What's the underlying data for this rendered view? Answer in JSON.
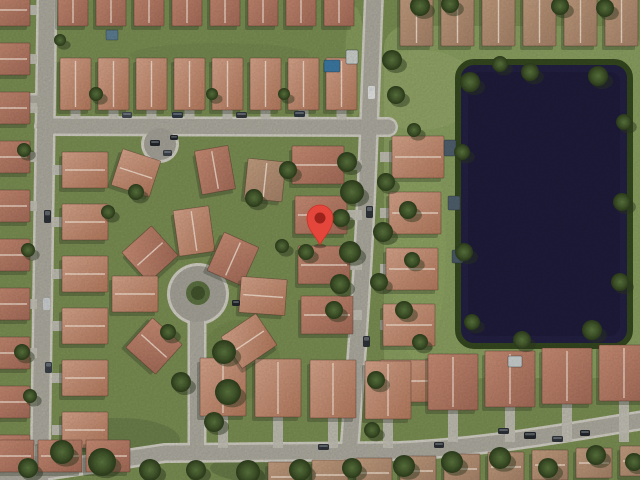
{
  "app": {
    "name": "satellite-map-view",
    "view_mode": "satellite"
  },
  "map": {
    "width": 640,
    "height": 480,
    "marker": {
      "tip_x": 320,
      "tip_y": 245,
      "head_dy": -27,
      "head_r": 13,
      "inner_r": 5.5,
      "color": "#e5463b",
      "edge_color": "#c63327",
      "inner_color": "#9c231b"
    },
    "palette": {
      "grass": "#7d9154",
      "lake_zone_grass": "#8ca262",
      "road": "#b0ada2",
      "road_edge": "#d6d3c8",
      "court_pavement": "#a8a59b",
      "island": "#5d7342",
      "island_tree": "#43552e",
      "driveway": "#c6c3b8",
      "lake": "#232043",
      "lake_edge": "#35491f",
      "house_shadow": "#2b3424",
      "roof_edge": "rgba(80,50,40,0.5)",
      "ridge": "rgba(255,238,222,0.8)",
      "tree_shadow": "#2c3a1e",
      "roof_gradients": [
        [
          "#cd9077",
          "#a86e5a"
        ],
        [
          "#dca88e",
          "#b77c5f"
        ],
        [
          "#c7a283",
          "#a9846a"
        ]
      ],
      "tree_gradient": [
        "#5d7840",
        "#44592c",
        "#2e3f1d"
      ]
    },
    "lake": {
      "x": 458,
      "y": 62,
      "w": 172,
      "h": 284,
      "rx": 16
    },
    "lake_zone": {
      "x": 384,
      "y": 26,
      "w": 256,
      "h": 352,
      "rx": 22
    },
    "roads": [
      {
        "d": "M 47,-5 L 40,485",
        "w": 16
      },
      {
        "d": "M -4,101 L 44,101",
        "w": 11
      },
      {
        "d": "M 44,126 L 388,127",
        "w": 15
      },
      {
        "d": "M 374,-6 L 369,127 C 366,210 362,292 349,454",
        "w": 15
      },
      {
        "d": "M -8,479 L 165,453 L 400,451 C 490,447 568,432 644,420",
        "w": 15
      },
      {
        "d": "M 197,452 L 197,312",
        "w": 14
      },
      {
        "d": "M 160,148 L 160,124",
        "w": 10
      }
    ],
    "circles": [
      {
        "cx": 198,
        "cy": 294,
        "r": 28,
        "kind": "cul-de-sac"
      },
      {
        "cx": 160,
        "cy": 144,
        "r": 16,
        "kind": "parking-court"
      }
    ],
    "island": {
      "cx": 198,
      "cy": 293,
      "r": 12,
      "tree_r": 7
    },
    "house_rows": [
      {
        "x": 58,
        "y": -20,
        "n": 8,
        "dx": 38,
        "dy": 0,
        "w": 30,
        "h": 46,
        "v": 0
      },
      {
        "x": 60,
        "y": 58,
        "n": 8,
        "dx": 38,
        "dy": 0,
        "w": 31,
        "h": 52,
        "v": 1,
        "drive": "S",
        "road": 119
      },
      {
        "x": 400,
        "y": -12,
        "n": 6,
        "dx": 41,
        "dy": 0,
        "w": 33,
        "h": 58,
        "v": 2
      },
      {
        "x": -16,
        "y": -6,
        "n": 10,
        "dx": 0,
        "dy": 49,
        "w": 46,
        "h": 32,
        "v": 0,
        "drive": "E",
        "road": 37
      },
      {
        "x": 62,
        "y": 152,
        "n": 6,
        "dx": 0,
        "dy": 52,
        "w": 46,
        "h": 36,
        "v": 1,
        "drive": "W",
        "road": 52
      },
      {
        "x": 292,
        "y": 146,
        "n": 4,
        "dx": 3,
        "dy": 50,
        "w": 52,
        "h": 38,
        "v": 0,
        "drive": "E",
        "road": 362
      },
      {
        "x": 392,
        "y": 136,
        "n": 5,
        "dx": -3,
        "dy": 56,
        "w": 52,
        "h": 42,
        "v": 1,
        "drive": "W",
        "road": 380
      },
      {
        "x": 200,
        "y": 358,
        "n": 4,
        "dx": 55,
        "dy": 1,
        "w": 46,
        "h": 58,
        "v": 1,
        "drive": "S",
        "road": 448
      },
      {
        "x": 428,
        "y": 354,
        "n": 4,
        "dx": 57,
        "dy": -3,
        "w": 50,
        "h": 56,
        "v": 0,
        "drive": "S",
        "road": 442
      },
      {
        "x": 268,
        "y": 462,
        "n": 9,
        "dx": 44,
        "dy": -2,
        "w": 36,
        "h": 30,
        "v": 2
      },
      {
        "x": -10,
        "y": 440,
        "n": 3,
        "dx": 48,
        "dy": 0,
        "w": 44,
        "h": 32,
        "v": 0
      }
    ],
    "houses_extra": [
      {
        "x": 176,
        "y": 208,
        "w": 36,
        "h": 46,
        "rot": -8,
        "v": 1
      },
      {
        "x": 130,
        "y": 234,
        "w": 40,
        "h": 40,
        "rot": -42,
        "v": 0
      },
      {
        "x": 112,
        "y": 276,
        "w": 46,
        "h": 36,
        "rot": 0,
        "v": 1
      },
      {
        "x": 134,
        "y": 326,
        "w": 40,
        "h": 40,
        "rot": 42,
        "v": 0
      },
      {
        "x": 214,
        "y": 238,
        "w": 38,
        "h": 42,
        "rot": 24,
        "v": 0
      },
      {
        "x": 240,
        "y": 278,
        "w": 46,
        "h": 36,
        "rot": 4,
        "v": 1
      },
      {
        "x": 228,
        "y": 322,
        "w": 42,
        "h": 38,
        "rot": -34,
        "v": 1
      },
      {
        "x": 116,
        "y": 154,
        "w": 40,
        "h": 38,
        "rot": 18,
        "v": 1
      },
      {
        "x": 198,
        "y": 148,
        "w": 34,
        "h": 44,
        "rot": -10,
        "v": 0
      },
      {
        "x": 246,
        "y": 160,
        "w": 38,
        "h": 40,
        "rot": 6,
        "v": 2
      }
    ],
    "pools": [
      {
        "x": 324,
        "y": 60,
        "w": 16,
        "h": 12,
        "c": "#3d7ba6"
      },
      {
        "x": 346,
        "y": 50,
        "w": 12,
        "h": 14,
        "c": "#cfd4cf"
      },
      {
        "x": 444,
        "y": 140,
        "w": 12,
        "h": 16,
        "c": "#50616e"
      },
      {
        "x": 448,
        "y": 196,
        "w": 12,
        "h": 14,
        "c": "#50616e"
      },
      {
        "x": 106,
        "y": 30,
        "w": 12,
        "h": 10,
        "c": "#5d7f93"
      },
      {
        "x": 452,
        "y": 250,
        "w": 11,
        "h": 13,
        "c": "#4a5a66"
      },
      {
        "x": 508,
        "y": 356,
        "w": 14,
        "h": 11,
        "c": "#cdd3d2"
      }
    ],
    "trees": [
      {
        "x": 347,
        "y": 162,
        "r": 10
      },
      {
        "x": 352,
        "y": 192,
        "r": 12
      },
      {
        "x": 341,
        "y": 218,
        "r": 9
      },
      {
        "x": 350,
        "y": 252,
        "r": 11
      },
      {
        "x": 340,
        "y": 284,
        "r": 10
      },
      {
        "x": 334,
        "y": 310,
        "r": 9
      },
      {
        "x": 306,
        "y": 252,
        "r": 8
      },
      {
        "x": 282,
        "y": 246,
        "r": 7
      },
      {
        "x": 224,
        "y": 352,
        "r": 12
      },
      {
        "x": 181,
        "y": 382,
        "r": 10
      },
      {
        "x": 228,
        "y": 392,
        "r": 13
      },
      {
        "x": 214,
        "y": 422,
        "r": 10
      },
      {
        "x": 168,
        "y": 332,
        "r": 8
      },
      {
        "x": 136,
        "y": 192,
        "r": 8
      },
      {
        "x": 254,
        "y": 198,
        "r": 9
      },
      {
        "x": 288,
        "y": 170,
        "r": 9
      },
      {
        "x": 108,
        "y": 212,
        "r": 7
      },
      {
        "x": 96,
        "y": 94,
        "r": 7
      },
      {
        "x": 212,
        "y": 94,
        "r": 6
      },
      {
        "x": 284,
        "y": 94,
        "r": 6
      },
      {
        "x": 60,
        "y": 40,
        "r": 6
      },
      {
        "x": 24,
        "y": 150,
        "r": 7
      },
      {
        "x": 28,
        "y": 250,
        "r": 7
      },
      {
        "x": 22,
        "y": 352,
        "r": 8
      },
      {
        "x": 30,
        "y": 396,
        "r": 7
      },
      {
        "x": 386,
        "y": 182,
        "r": 9
      },
      {
        "x": 383,
        "y": 232,
        "r": 10
      },
      {
        "x": 379,
        "y": 282,
        "r": 9
      },
      {
        "x": 414,
        "y": 130,
        "r": 7
      },
      {
        "x": 392,
        "y": 60,
        "r": 10
      },
      {
        "x": 396,
        "y": 95,
        "r": 9
      },
      {
        "x": 62,
        "y": 452,
        "r": 12
      },
      {
        "x": 102,
        "y": 462,
        "r": 14
      },
      {
        "x": 28,
        "y": 468,
        "r": 10
      },
      {
        "x": 150,
        "y": 470,
        "r": 11
      },
      {
        "x": 196,
        "y": 470,
        "r": 10
      },
      {
        "x": 248,
        "y": 472,
        "r": 12
      },
      {
        "x": 300,
        "y": 470,
        "r": 11
      },
      {
        "x": 352,
        "y": 468,
        "r": 10
      },
      {
        "x": 404,
        "y": 466,
        "r": 11
      },
      {
        "x": 452,
        "y": 462,
        "r": 11
      },
      {
        "x": 500,
        "y": 458,
        "r": 11
      },
      {
        "x": 548,
        "y": 468,
        "r": 10
      },
      {
        "x": 596,
        "y": 455,
        "r": 10
      },
      {
        "x": 634,
        "y": 462,
        "r": 9
      },
      {
        "x": 470,
        "y": 82,
        "r": 10
      },
      {
        "x": 530,
        "y": 72,
        "r": 9
      },
      {
        "x": 598,
        "y": 76,
        "r": 10
      },
      {
        "x": 624,
        "y": 122,
        "r": 8
      },
      {
        "x": 622,
        "y": 202,
        "r": 9
      },
      {
        "x": 620,
        "y": 282,
        "r": 9
      },
      {
        "x": 592,
        "y": 330,
        "r": 10
      },
      {
        "x": 522,
        "y": 340,
        "r": 9
      },
      {
        "x": 472,
        "y": 322,
        "r": 8
      },
      {
        "x": 462,
        "y": 152,
        "r": 8
      },
      {
        "x": 464,
        "y": 252,
        "r": 9
      },
      {
        "x": 500,
        "y": 64,
        "r": 8
      },
      {
        "x": 420,
        "y": 6,
        "r": 10
      },
      {
        "x": 450,
        "y": 4,
        "r": 9
      },
      {
        "x": 560,
        "y": 6,
        "r": 9
      },
      {
        "x": 605,
        "y": 8,
        "r": 9
      },
      {
        "x": 408,
        "y": 210,
        "r": 9
      },
      {
        "x": 412,
        "y": 260,
        "r": 8
      },
      {
        "x": 404,
        "y": 310,
        "r": 9
      },
      {
        "x": 376,
        "y": 380,
        "r": 9
      },
      {
        "x": 420,
        "y": 342,
        "r": 8
      },
      {
        "x": 372,
        "y": 430,
        "r": 8
      }
    ],
    "cars": [
      {
        "x": 44,
        "y": 210,
        "w": 7,
        "h": 13,
        "c": "#2e3338"
      },
      {
        "x": 43,
        "y": 298,
        "w": 7,
        "h": 12,
        "c": "#cfd2d4"
      },
      {
        "x": 45,
        "y": 362,
        "w": 7,
        "h": 11,
        "c": "#3a4148"
      },
      {
        "x": 368,
        "y": 86,
        "w": 7,
        "h": 13,
        "c": "#e8e8e6"
      },
      {
        "x": 366,
        "y": 206,
        "w": 7,
        "h": 12,
        "c": "#30353b"
      },
      {
        "x": 363,
        "y": 336,
        "w": 7,
        "h": 11,
        "c": "#2e3338"
      },
      {
        "x": 150,
        "y": 140,
        "w": 10,
        "h": 6,
        "c": "#23272c"
      },
      {
        "x": 163,
        "y": 150,
        "w": 9,
        "h": 6,
        "c": "#3c4349"
      },
      {
        "x": 170,
        "y": 135,
        "w": 8,
        "h": 5,
        "c": "#23272c"
      },
      {
        "x": 122,
        "y": 112,
        "w": 10,
        "h": 6,
        "c": "#444a52"
      },
      {
        "x": 172,
        "y": 112,
        "w": 11,
        "h": 6,
        "c": "#2f3a45"
      },
      {
        "x": 236,
        "y": 112,
        "w": 11,
        "h": 6,
        "c": "#33373c"
      },
      {
        "x": 294,
        "y": 111,
        "w": 11,
        "h": 6,
        "c": "#2d3640"
      },
      {
        "x": 232,
        "y": 300,
        "w": 8,
        "h": 6,
        "c": "#23272c"
      },
      {
        "x": 498,
        "y": 428,
        "w": 11,
        "h": 6,
        "c": "#2c3036"
      },
      {
        "x": 524,
        "y": 432,
        "w": 12,
        "h": 7,
        "c": "#23272c"
      },
      {
        "x": 552,
        "y": 436,
        "w": 11,
        "h": 6,
        "c": "#32373d"
      },
      {
        "x": 580,
        "y": 430,
        "w": 10,
        "h": 6,
        "c": "#23272c"
      },
      {
        "x": 434,
        "y": 442,
        "w": 10,
        "h": 6,
        "c": "#2c3036"
      },
      {
        "x": 318,
        "y": 444,
        "w": 11,
        "h": 6,
        "c": "#30353b"
      }
    ],
    "grass_patches": [
      {
        "x": 420,
        "y": 90,
        "rx": 60,
        "ry": 40,
        "c": "#9cae70",
        "o": 0.5
      },
      {
        "x": 355,
        "y": 62,
        "rx": 10,
        "ry": 55,
        "c": "#8ba160",
        "o": 0.8
      },
      {
        "x": 220,
        "y": 55,
        "rx": 90,
        "ry": 12,
        "c": "#72874e",
        "o": 0.5
      },
      {
        "x": 120,
        "y": 440,
        "rx": 60,
        "ry": 22,
        "c": "#5e7242",
        "o": 0.45
      },
      {
        "x": 300,
        "y": 468,
        "rx": 90,
        "ry": 18,
        "c": "#566a3c",
        "o": 0.5
      },
      {
        "x": 418,
        "y": 250,
        "rx": 28,
        "ry": 110,
        "c": "#94aa68",
        "o": 0.45
      },
      {
        "x": 240,
        "y": 360,
        "rx": 40,
        "ry": 40,
        "c": "#6b8049",
        "o": 0.35
      }
    ]
  }
}
